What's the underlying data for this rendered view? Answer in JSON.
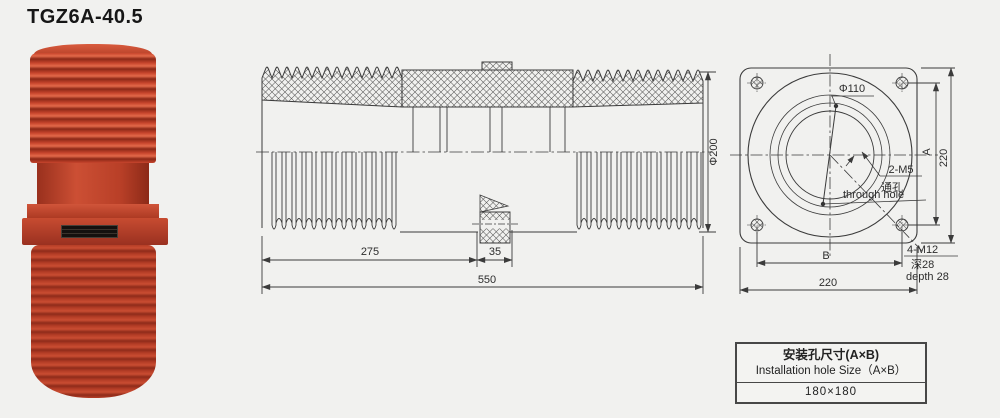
{
  "title": "TGZ6A-40.5",
  "colors": {
    "product_red": "#bb4029",
    "product_rib_dark": "#8c2817",
    "product_highlight": "#e2694a",
    "line": "#3b3b3b",
    "background": "#f1f1ef"
  },
  "side_view": {
    "dim_275": "275",
    "dim_35": "35",
    "dim_550": "550",
    "dim_diameter": "Φ200"
  },
  "front_view": {
    "hole_diameter": "Φ110",
    "m5_label": "2-M5",
    "m5_cn": "通孔",
    "m5_en": "through hole",
    "m12_label": "4-M12",
    "m12_cn": "深28",
    "m12_en": "depth 28",
    "dim_a": "A",
    "dim_b": "B",
    "dim_height": "220",
    "dim_width": "220"
  },
  "install_table": {
    "title_cn": "安装孔尺寸(A×B)",
    "title_en": "Installation hole Size（A×B）",
    "value": "180×180"
  }
}
